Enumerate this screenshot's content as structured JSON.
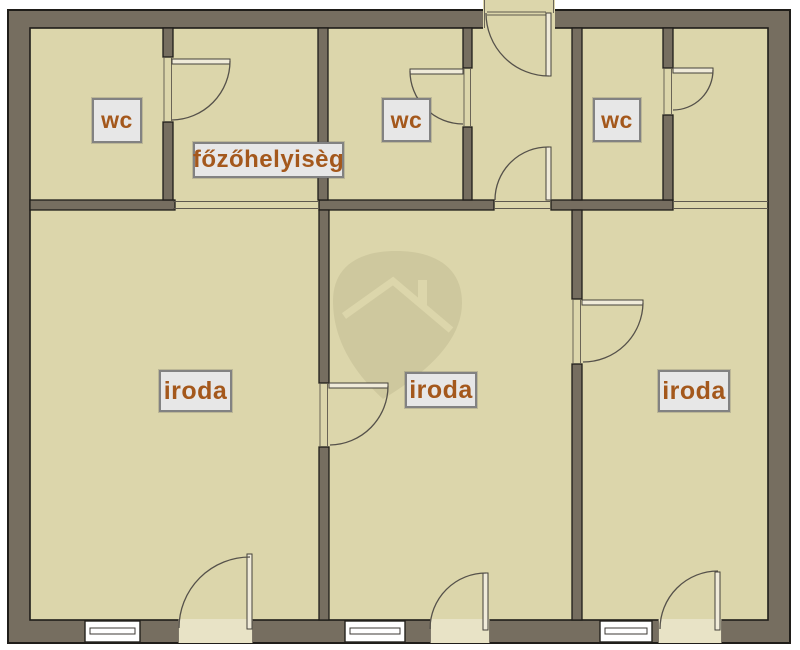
{
  "plan": {
    "type": "floor-plan",
    "rooms": [
      {
        "id": "wc-top-left",
        "label": "wc"
      },
      {
        "id": "kitchen",
        "label": "főzőhelyisèg"
      },
      {
        "id": "wc-top-middle",
        "label": "wc"
      },
      {
        "id": "wc-top-right",
        "label": "wc"
      },
      {
        "id": "office-left",
        "label": "iroda"
      },
      {
        "id": "office-middle",
        "label": "iroda"
      },
      {
        "id": "office-right",
        "label": "iroda"
      }
    ],
    "colors": {
      "background": "#ffffff",
      "wall": "#766e60",
      "wall_outline": "#1f1d19",
      "floor": "#dcd6ab",
      "threshold": "#e8e3c6",
      "label_background": "#e7e7e7",
      "label_border": "#828282",
      "label_text": "#a4581c",
      "watermark": "#cec89e"
    },
    "watermark_icon": "house-location-pin"
  }
}
